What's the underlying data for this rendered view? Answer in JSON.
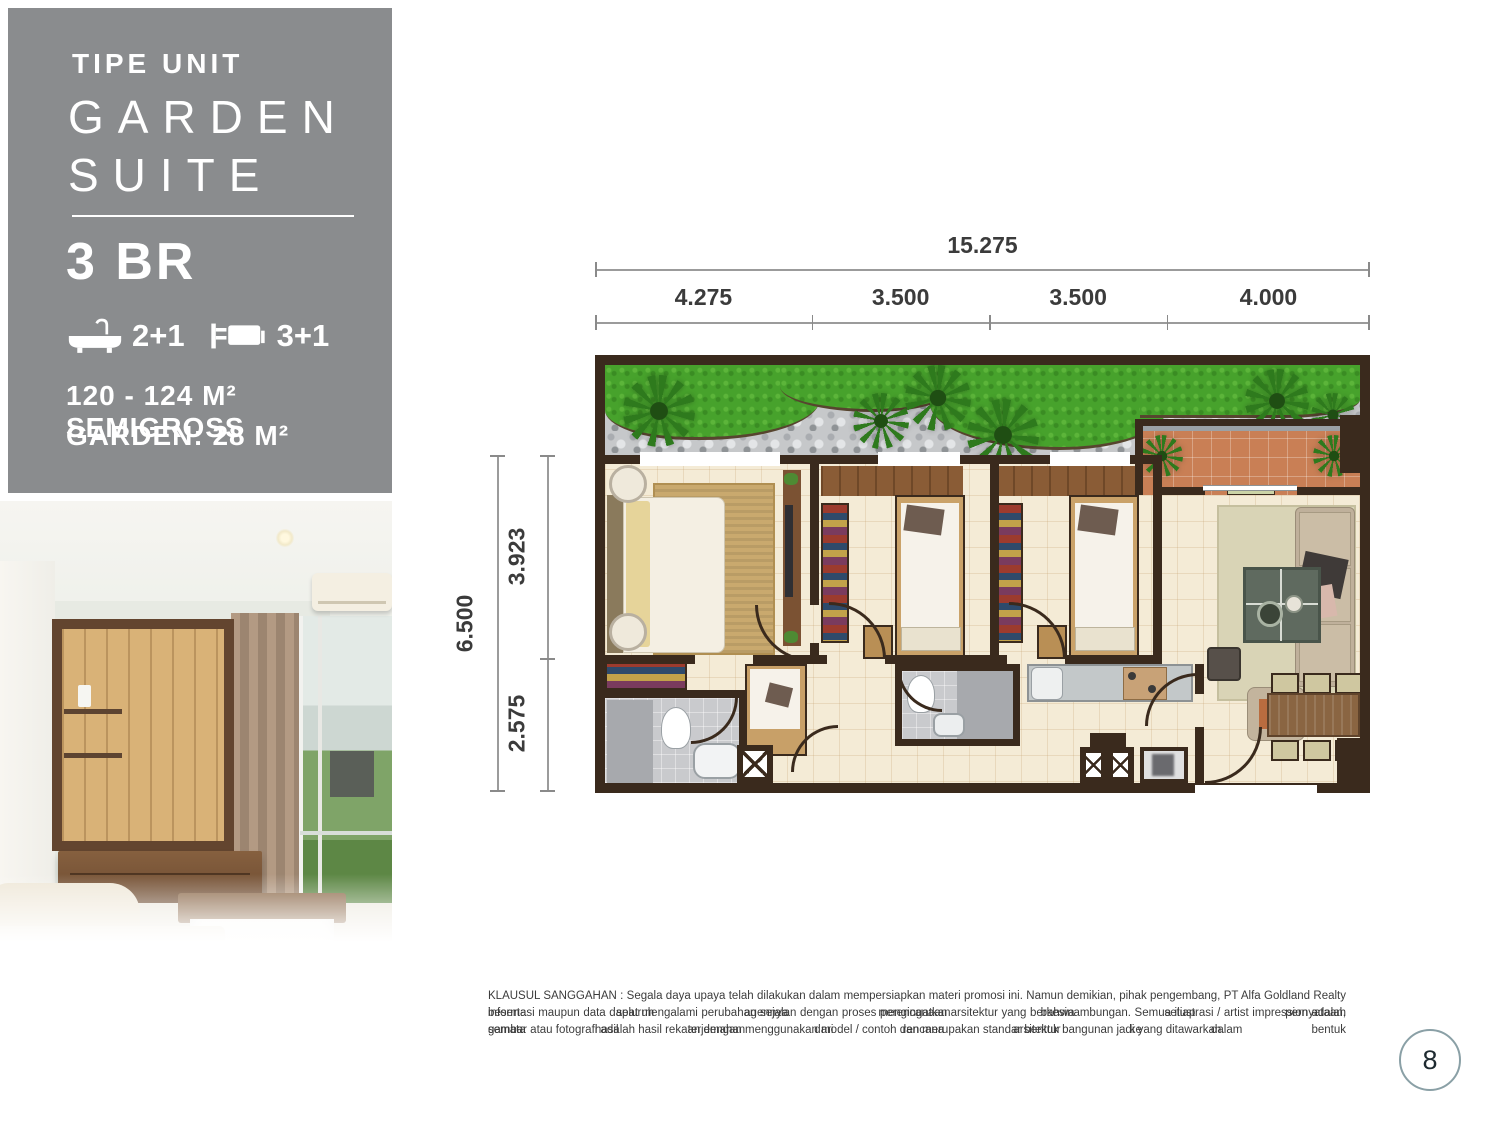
{
  "panel": {
    "eyebrow": "TIPE UNIT",
    "title_line1": "GARDEN",
    "title_line2": "SUITE",
    "unit": "3 BR",
    "bath_count": "2+1",
    "bed_count": "3+1",
    "area": "120 - 124 M²  SEMIGROSS",
    "garden_area": "GARDEN: 28 M²",
    "bg_color": "#8a8c8e",
    "icons": {
      "bath": "bathtub-icon",
      "bed": "bed-icon"
    }
  },
  "plan": {
    "dim_total_width": "15.275",
    "dim_segments": [
      "4.275",
      "3.500",
      "3.500",
      "4.000"
    ],
    "dim_total_height": "6.500",
    "dim_height_segments": [
      "3.923",
      "2.575"
    ],
    "colors": {
      "wall": "#3a2a1d",
      "floor": "#f4ebd6",
      "grass": "#47a22c",
      "gravel": "#c6c8ca",
      "terrace": "#c97f55"
    }
  },
  "footer": {
    "disclaimer_line1": "KLAUSUL SANGGAHAN : Segala daya upaya telah dilakukan dalam mempersiapkan materi promosi ini. Namun demikian, pihak pengembang, PT Alfa Goldland Realty beserta seluruh agennya mengingatkan bahwa setiap pernyataan,",
    "disclaimer_line2": "informasi maupun data dapat mengalami perubahan sejalan dengan proses perencanaan arsitektur yang berkesinambungan. Semua ilustrasi / artist impression adalah semata hasil terjemahan dari rencana arsitektur ke dalam bentuk",
    "disclaimer_line3": "gambar atau fotografi adalah hasil rekaan dengan menggunakan model / contoh dan merupakan standar bentuk bangunan jadi yang ditawarkan.",
    "page_number": "8"
  }
}
